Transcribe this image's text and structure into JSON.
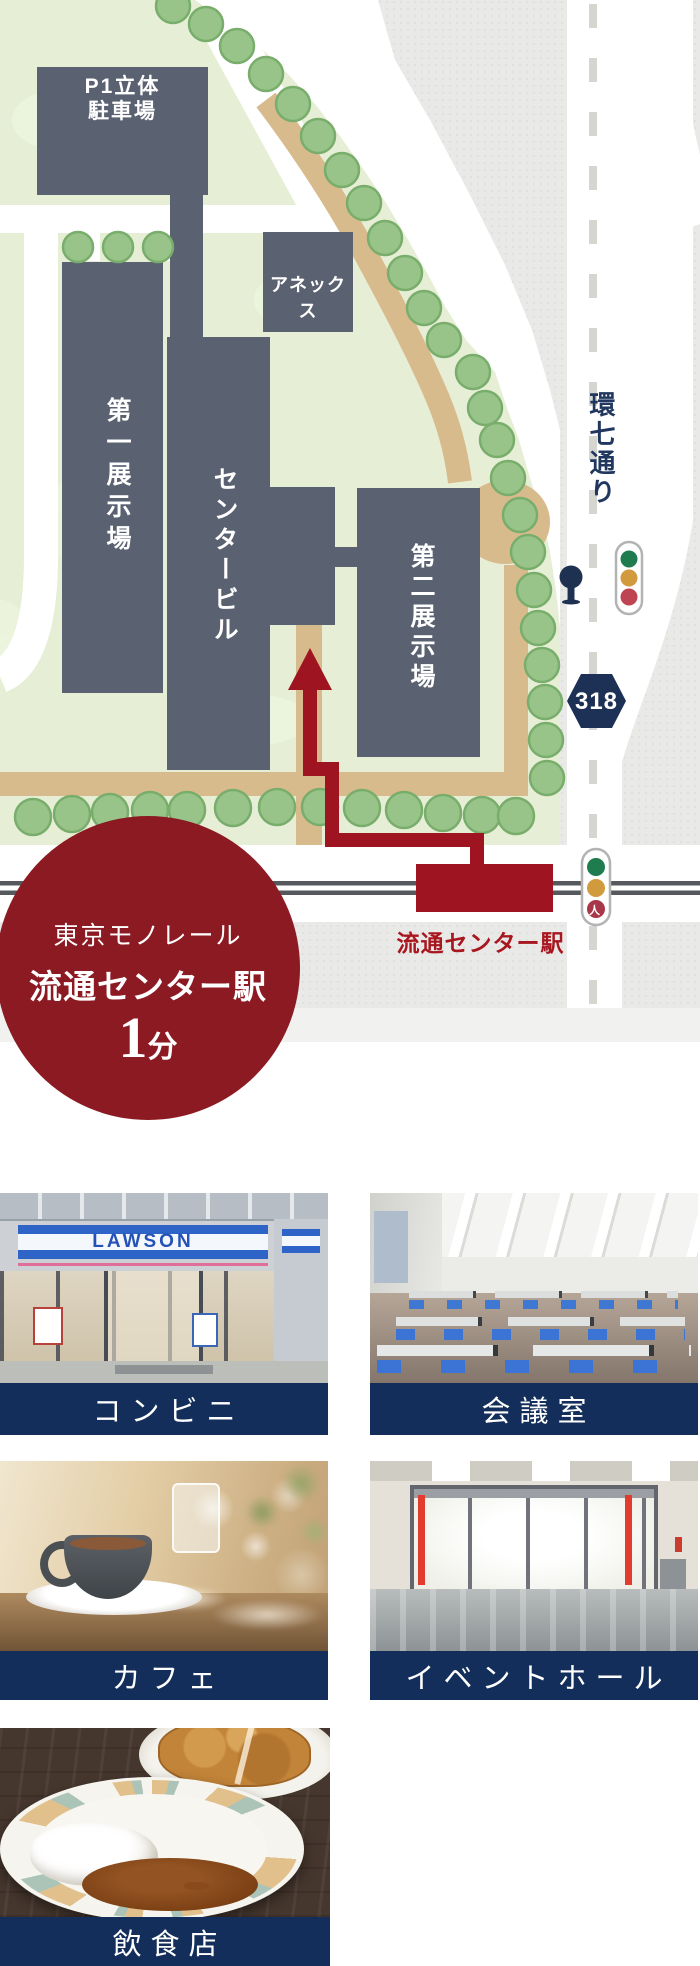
{
  "map": {
    "buildings": {
      "parking_line1": "P1立体",
      "parking_line2": "駐車場",
      "annex": "アネックス",
      "exhibition_hall_1": "第一展示場",
      "center_building": "センタービル",
      "exhibition_hall_2": "第二展示場"
    },
    "road": {
      "name": "環七通り",
      "route_number": "318"
    },
    "station_label": "流通センター駅",
    "traffic_light_pedestrian_glyph": "人",
    "access_badge": {
      "line1": "東京モノレール",
      "line2": "流通センター駅",
      "minutes": "1",
      "minutes_unit": "分"
    },
    "colors": {
      "building": "#5a6170",
      "campus_green": "#e6efd5",
      "route_red": "#9e1420",
      "badge_red": "#8c1a22",
      "route_badge_navy": "#1d3156",
      "caption_navy": "#132e5a"
    }
  },
  "facilities": [
    {
      "label": "コンビニ",
      "photo": "convenience-store-lawson",
      "sign": "LAWSON"
    },
    {
      "label": "会議室",
      "photo": "meeting-room"
    },
    {
      "label": "カフェ",
      "photo": "cafe"
    },
    {
      "label": "イベントホール",
      "photo": "event-hall"
    },
    {
      "label": "飲食店",
      "photo": "restaurant"
    }
  ]
}
